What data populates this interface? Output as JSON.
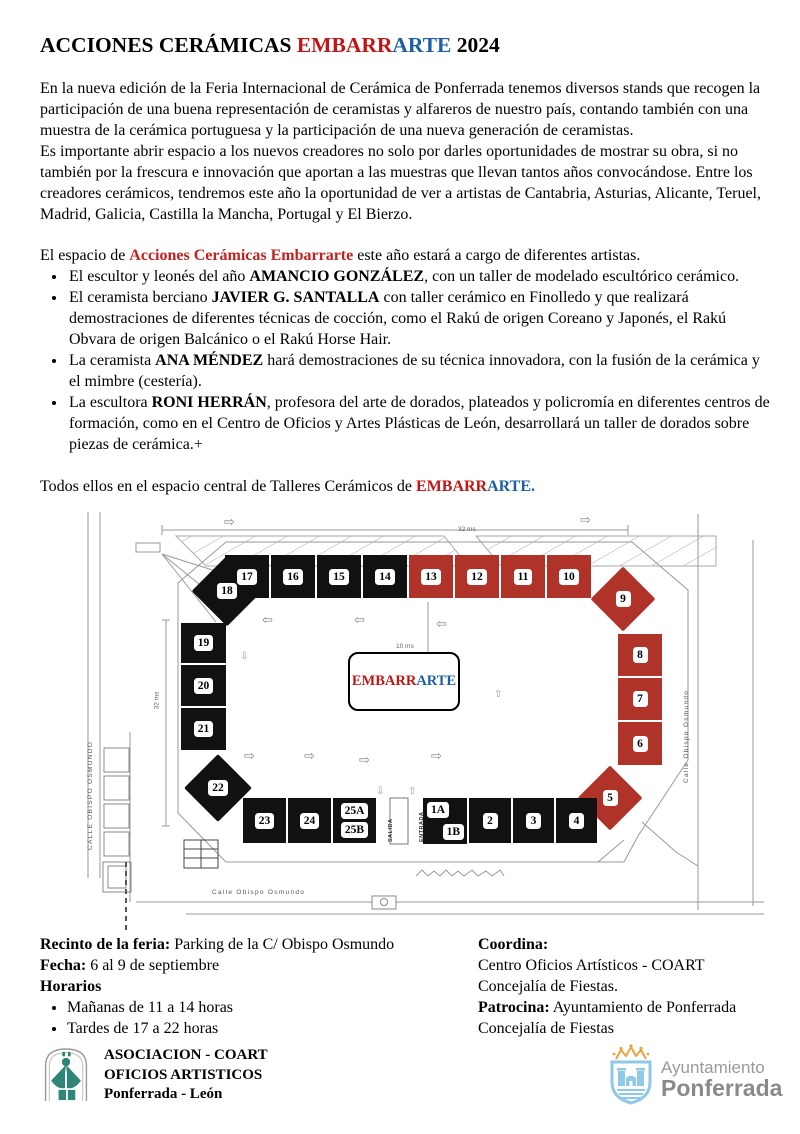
{
  "title": {
    "prefix": "ACCIONES CERÁMICAS ",
    "red": "EMBARR",
    "blue": "ARTE",
    "suffix": " 2024"
  },
  "intro": [
    "En la nueva edición de la Feria Internacional de Cerámica de Ponferrada tenemos  diversos stands que recogen la participación de una buena representación de ceramistas y alfareros de nuestro país, contando también con una muestra de la cerámica portuguesa y la participación de una nueva generación de ceramistas.",
    "Es importante abrir espacio a los nuevos creadores no solo por darles oportunidades de mostrar su obra, si no también por la frescura e innovación que aportan a las muestras que llevan tantos años convocándose. Entre los creadores cerámicos, tendremos este año la oportunidad de ver a artistas de Cantabria, Asturias, Alicante, Teruel, Madrid, Galicia, Castilla la Mancha, Portugal y El Bierzo."
  ],
  "espacio": {
    "pre": "El espacio de ",
    "highlight": "Acciones Cerámicas Embarrarte",
    "post": " este año estará a cargo de diferentes artistas."
  },
  "artists": [
    {
      "pre": "El escultor y leonés del año ",
      "name": "AMANCIO GONZÁLEZ",
      "post": ", con un taller de modelado escultórico cerámico."
    },
    {
      "pre": "El ceramista berciano ",
      "name": "JAVIER G. SANTALLA",
      "post": " con taller cerámico en Finolledo y que  realizará demostraciones de diferentes técnicas de cocción, como el Rakú de origen Coreano y Japonés, el Rakú Obvara de origen Balcánico o el Rakú Horse Hair."
    },
    {
      "pre": "La ceramista ",
      "name": "ANA MÉNDEZ",
      "post": " hará demostraciones  de su técnica innovadora, con la fusión de la cerámica y el mimbre (cestería)."
    },
    {
      "pre": "La escultora ",
      "name": "RONI HERRÁN",
      "post": ", profesora del arte de dorados, plateados y policromía en diferentes centros de formación, como en el Centro de Oficios y Artes Plásticas de León, desarrollará un taller de dorados sobre piezas de cerámica.+"
    }
  ],
  "todos": {
    "pre": "Todos ellos en el espacio central de Talleres Cerámicos de ",
    "red": "EMBARR",
    "blue": "ARTE."
  },
  "map": {
    "center_label": {
      "red": "EMBARR",
      "blue": "ARTE"
    },
    "streets": {
      "left": "CALLE  OBISPO OSMUNDO",
      "right": "Calle  Obispo Osmundo",
      "bottom": "Calle Obispo Osmundo"
    },
    "entrance": {
      "salida": "SALIDA",
      "entrada": "ENTRADA"
    },
    "dims": {
      "top": "32 ms",
      "left": "32 ms",
      "right": "10 ms"
    },
    "stands": [
      {
        "labels": [
          "17"
        ],
        "color": "black",
        "shape": "square",
        "x": 149,
        "y": 45,
        "w": 44,
        "h": 43
      },
      {
        "labels": [
          "16"
        ],
        "color": "black",
        "shape": "square",
        "x": 195,
        "y": 45,
        "w": 44,
        "h": 43
      },
      {
        "labels": [
          "15"
        ],
        "color": "black",
        "shape": "square",
        "x": 241,
        "y": 45,
        "w": 44,
        "h": 43
      },
      {
        "labels": [
          "14"
        ],
        "color": "black",
        "shape": "square",
        "x": 287,
        "y": 45,
        "w": 44,
        "h": 43
      },
      {
        "labels": [
          "13"
        ],
        "color": "red",
        "shape": "square",
        "x": 333,
        "y": 45,
        "w": 44,
        "h": 43
      },
      {
        "labels": [
          "12"
        ],
        "color": "red",
        "shape": "square",
        "x": 379,
        "y": 45,
        "w": 44,
        "h": 43
      },
      {
        "labels": [
          "11"
        ],
        "color": "red",
        "shape": "square",
        "x": 425,
        "y": 45,
        "w": 44,
        "h": 43
      },
      {
        "labels": [
          "10"
        ],
        "color": "red",
        "shape": "square",
        "x": 471,
        "y": 45,
        "w": 44,
        "h": 43
      },
      {
        "labels": [
          "9"
        ],
        "color": "red",
        "shape": "diamond",
        "x": 524,
        "y": 66,
        "w": 46,
        "h": 46
      },
      {
        "labels": [
          "8"
        ],
        "color": "red",
        "shape": "square",
        "x": 542,
        "y": 124,
        "w": 44,
        "h": 42
      },
      {
        "labels": [
          "7"
        ],
        "color": "red",
        "shape": "square",
        "x": 542,
        "y": 168,
        "w": 44,
        "h": 42
      },
      {
        "labels": [
          "6"
        ],
        "color": "red",
        "shape": "square",
        "x": 542,
        "y": 212,
        "w": 44,
        "h": 43
      },
      {
        "labels": [
          "5"
        ],
        "color": "red",
        "shape": "diamond",
        "x": 511,
        "y": 265,
        "w": 46,
        "h": 46
      },
      {
        "labels": [
          "18"
        ],
        "color": "black",
        "shape": "diamond",
        "x": 126,
        "y": 56,
        "w": 50,
        "h": 50
      },
      {
        "labels": [
          "19"
        ],
        "color": "black",
        "shape": "square",
        "x": 105,
        "y": 113,
        "w": 45,
        "h": 40
      },
      {
        "labels": [
          "20"
        ],
        "color": "black",
        "shape": "square",
        "x": 105,
        "y": 155,
        "w": 45,
        "h": 41
      },
      {
        "labels": [
          "21"
        ],
        "color": "black",
        "shape": "square",
        "x": 105,
        "y": 198,
        "w": 45,
        "h": 42
      },
      {
        "labels": [
          "22"
        ],
        "color": "black",
        "shape": "diamond",
        "x": 118,
        "y": 254,
        "w": 48,
        "h": 48
      },
      {
        "labels": [
          "23"
        ],
        "color": "black",
        "shape": "square",
        "x": 167,
        "y": 288,
        "w": 43,
        "h": 45
      },
      {
        "labels": [
          "24"
        ],
        "color": "black",
        "shape": "square",
        "x": 212,
        "y": 288,
        "w": 43,
        "h": 45
      },
      {
        "labels": [
          "25A",
          "25B"
        ],
        "color": "black",
        "shape": "square",
        "x": 257,
        "y": 288,
        "w": 43,
        "h": 45
      },
      {
        "labels": [
          "1A",
          "1B"
        ],
        "color": "black",
        "shape": "square",
        "diag": true,
        "x": 347,
        "y": 288,
        "w": 44,
        "h": 46
      },
      {
        "labels": [
          "2"
        ],
        "color": "black",
        "shape": "square",
        "x": 393,
        "y": 288,
        "w": 42,
        "h": 45
      },
      {
        "labels": [
          "3"
        ],
        "color": "black",
        "shape": "square",
        "x": 437,
        "y": 288,
        "w": 41,
        "h": 45
      },
      {
        "labels": [
          "4"
        ],
        "color": "black",
        "shape": "square",
        "x": 480,
        "y": 288,
        "w": 41,
        "h": 45
      }
    ],
    "arrows": [
      {
        "g": "right",
        "x": 148,
        "y": 6,
        "s": "big"
      },
      {
        "g": "right",
        "x": 504,
        "y": 4,
        "s": "big"
      },
      {
        "g": "left",
        "x": 186,
        "y": 104,
        "s": "big"
      },
      {
        "g": "left",
        "x": 278,
        "y": 104,
        "s": "big"
      },
      {
        "g": "left",
        "x": 360,
        "y": 108,
        "s": "big"
      },
      {
        "g": "right",
        "x": 168,
        "y": 240,
        "s": "big"
      },
      {
        "g": "right",
        "x": 228,
        "y": 240,
        "s": "big"
      },
      {
        "g": "right",
        "x": 283,
        "y": 244,
        "s": "big"
      },
      {
        "g": "right",
        "x": 355,
        "y": 240,
        "s": "big"
      },
      {
        "g": "down",
        "x": 164,
        "y": 142,
        "s": "small"
      },
      {
        "g": "up",
        "x": 418,
        "y": 180,
        "s": "small"
      },
      {
        "g": "down",
        "x": 300,
        "y": 277,
        "s": "small"
      },
      {
        "g": "up",
        "x": 332,
        "y": 277,
        "s": "small"
      }
    ]
  },
  "details": {
    "left": {
      "recinto_label": "Recinto de la feria:",
      "recinto_value": " Parking de la C/ Obispo Osmundo",
      "fecha_label": "Fecha:",
      "fecha_value": " 6 al 9 de septiembre",
      "horarios_label": "Horarios",
      "items": [
        "Mañanas de 11 a  14 horas",
        "Tardes de 17 a 22 horas"
      ]
    },
    "right": {
      "coordina_label": "Coordina:",
      "coordina_line1": "Centro Oficios Artísticos - COART",
      "coordina_line2": "Concejalía de Fiestas.",
      "patrocina_label": "Patrocina:",
      "patrocina_value": " Ayuntamiento de Ponferrada",
      "patrocina_line2": "Concejalía de Fiestas"
    }
  },
  "logos": {
    "coart": {
      "line1": "ASOCIACION -  COART",
      "line2": "OFICIOS ARTISTICOS",
      "line3": "Ponferrada - León"
    },
    "ayto": {
      "line1": "Ayuntamiento",
      "line2": "Ponferrada"
    }
  },
  "colors": {
    "title_red": "#c41414",
    "title_blue": "#1d5fa7",
    "accent_red": "#c42020",
    "stand_black": "#111111",
    "stand_red": "#b0332a",
    "logo_teal": "#2e8578",
    "ayto_blue": "#8fc9e8",
    "ayto_orange": "#f0a23e",
    "ayto_gray": "#8c8c8c"
  }
}
